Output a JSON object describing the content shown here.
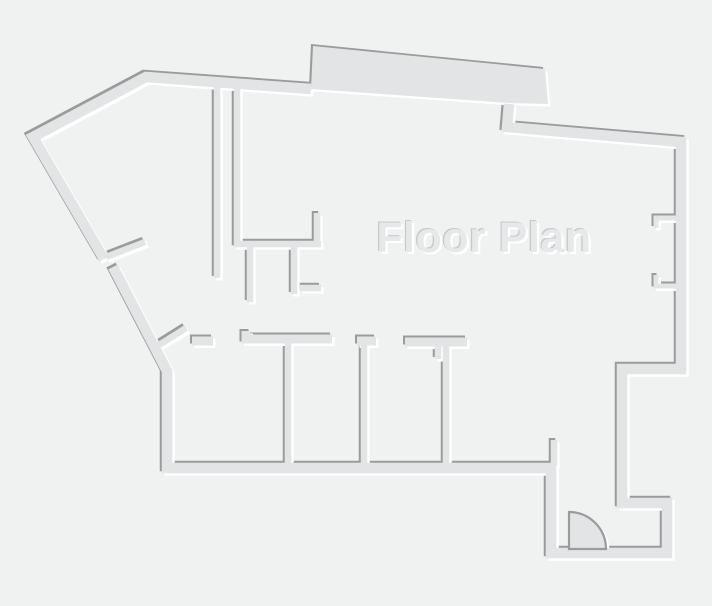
{
  "title": "Floor Plan",
  "canvas": {
    "width": 712,
    "height": 606
  },
  "colors": {
    "background": "#f0f1f1",
    "wall_fill": "#e3e4e5",
    "edge_dark": "#9b9b9b",
    "edge_light": "#ffffff",
    "title_fill": "#e7e8e9",
    "title_shadow_dark": "#c6c7c9",
    "title_shadow_light": "#ffffff"
  },
  "floorplan": {
    "emboss": {
      "dark_offset": -2,
      "light_offset": 2.5
    },
    "outer_width": 10.5,
    "outer_walls": [
      "M104 259 L33 137 L146 77 L311 89",
      "M509 104 L507 127 L681 142 L681 369 L622 369 L622 503 L667 503 L667 553 L551 553 L551 468 L167 468 L167 371 L113 267"
    ],
    "protrusion_slab": "M313 46 L545 69 L548 104 L509 103 L311 89 Z",
    "slab_width": 9,
    "top_wall_pieces": [
      "M192 341 L213 341",
      "M246 331 L246 339 L332 339",
      "M357 341 L376 341",
      "M405 342 L467 342"
    ],
    "interior_width": 6.5,
    "interior_walls": [
      "M217 84 L217 278",
      "M237 85 L237 244 L321 244",
      "M317 246 L317 213",
      "M250 247 L250 302",
      "M294 247 L294 294",
      "M300 288 L321 288",
      "M106 257 L145 242",
      "M159 345 L186 328",
      "M288 339 L288 468",
      "M364 341 L364 468",
      "M446 342 L446 468",
      "M438 344 L438 359",
      "M554 440 L554 466"
    ],
    "bracket_width": 5,
    "window_brackets": [
      "M680 218 L656 218 L656 228",
      "M656 275 L656 286 L680 286"
    ],
    "door": {
      "path": "M569 512 A37 37 0 0 1 606 549 L569 549 Z",
      "stroke_width": 2.2
    },
    "label": {
      "x": 484,
      "y": 252,
      "font_size": 43
    }
  }
}
